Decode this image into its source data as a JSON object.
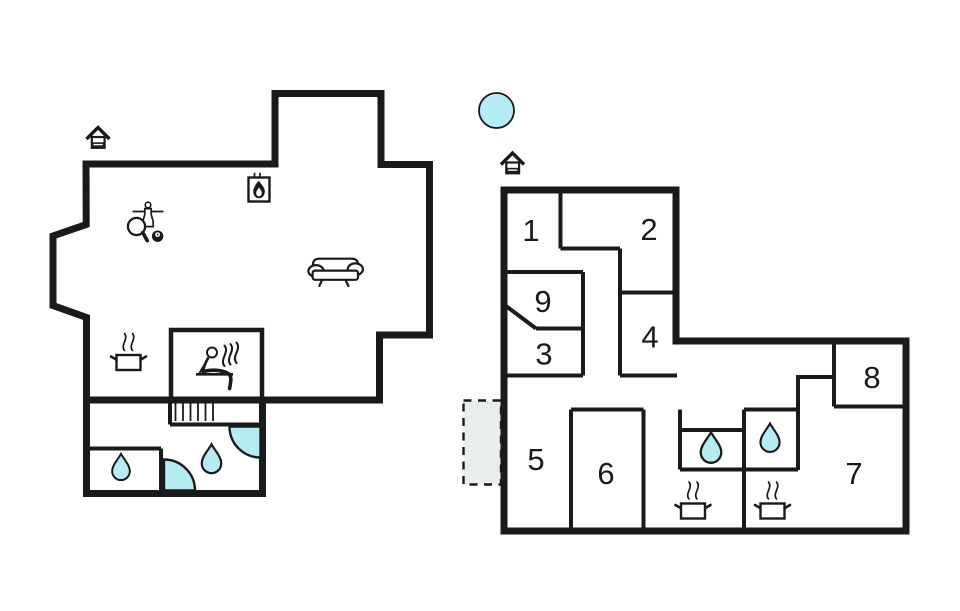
{
  "palette": {
    "background": "#ffffff",
    "wall": "#1a1a1a",
    "water": "#b5ecf4",
    "terrace_fill": "#e9edec"
  },
  "plan": {
    "type": "vacation-house-floor-plan",
    "buildings": [
      "left-building",
      "right-building"
    ],
    "rooms": {
      "r1": "1",
      "r2": "2",
      "r3": "3",
      "r4": "4",
      "r5": "5",
      "r6": "6",
      "r7": "7",
      "r8": "8",
      "r9": "9"
    },
    "icons": [
      "entrance-icon",
      "fireplace-icon",
      "table-football-icon",
      "table-tennis-paddle-icon",
      "billiard-ball-icon",
      "sofa-icon",
      "cooking-pot-icon",
      "steam-icon",
      "sauna-person-icon",
      "stairs-icon",
      "water-drop-icon",
      "shower-quarter-icon",
      "pool-icon",
      "terrace-dashed-area"
    ]
  }
}
